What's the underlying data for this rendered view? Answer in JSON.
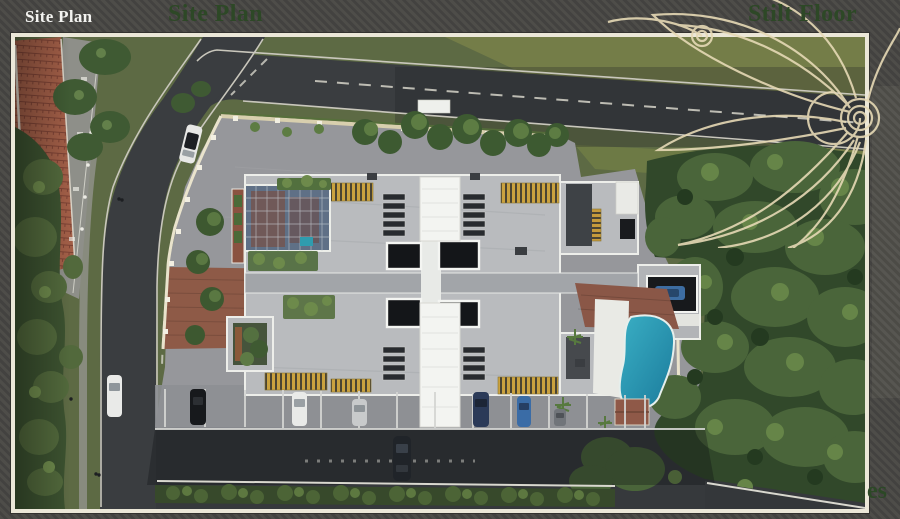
{
  "header": {
    "page_label": "Site Plan",
    "current_slide_title": "Site Plan",
    "next_slide_title": "Stilt Floor"
  },
  "render": {
    "clipped_caption_fragment": "es"
  },
  "colors": {
    "accent_green": "#2d4826",
    "frame_cream": "#ebe7d8",
    "page_background": "#4b4a46",
    "pool_teal": "#2ba0b6",
    "roof_gray": "#b9bbbe",
    "pergola_yellow": "#caa23f",
    "terracotta_roof": "#9d5b45",
    "asphalt": "#3a3d40"
  },
  "scene": {
    "description": "Aerial 3D render of an apartment site plan: central building with roof pergolas and glass atrium, swimming pool, parking bays with cars, perimeter roads, compound wall and dense trees"
  }
}
